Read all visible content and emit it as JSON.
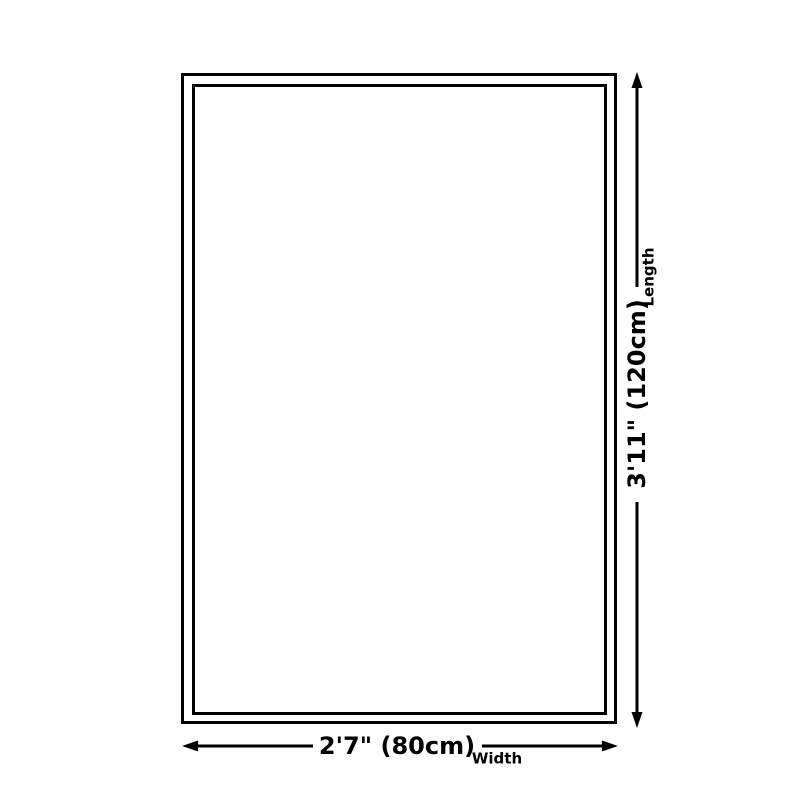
{
  "diagram": {
    "background_color": "#ffffff",
    "line_color": "#000000",
    "shape": "rectangle-double-border",
    "length": {
      "value": "3'11\" (120cm)",
      "axis": "Length"
    },
    "width": {
      "value": "2'7\" (80cm)",
      "axis": "Width"
    }
  }
}
